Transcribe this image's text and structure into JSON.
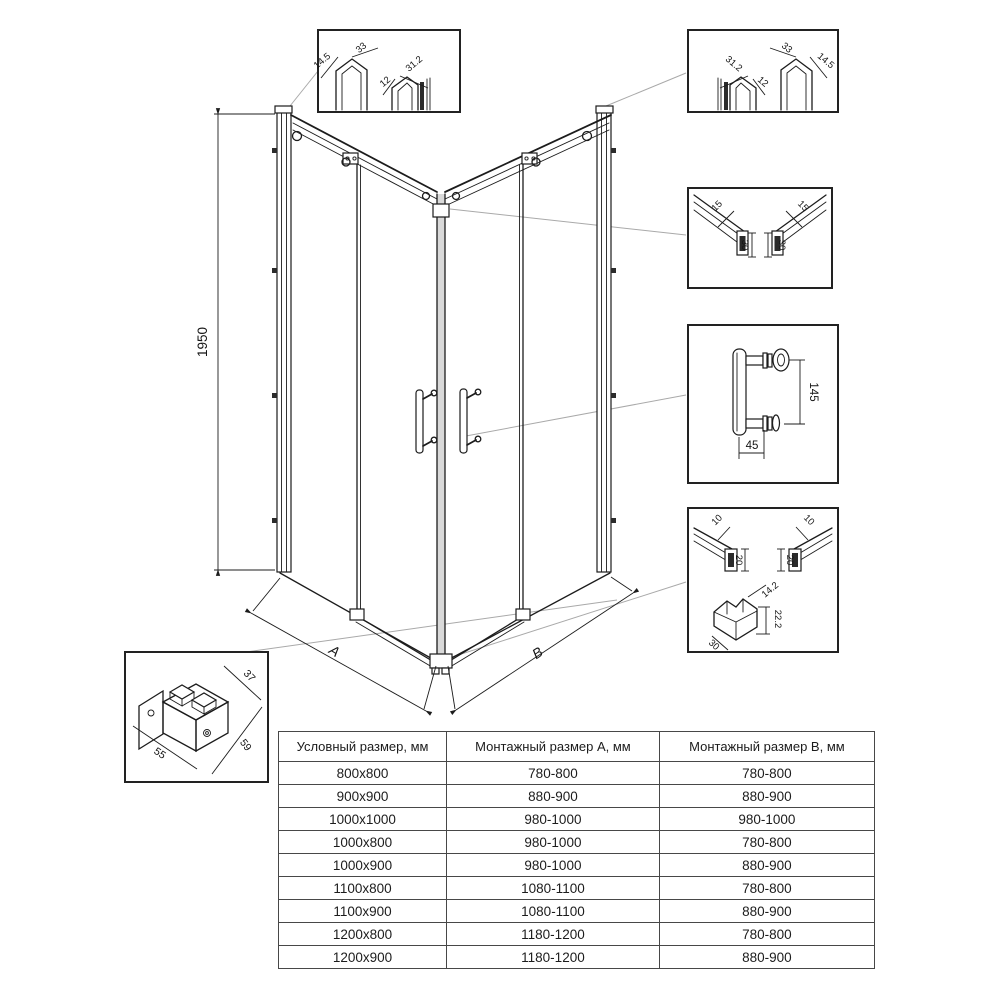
{
  "drawing": {
    "height_dim": "1950",
    "dim_a": "A",
    "dim_b": "B"
  },
  "details": {
    "wall_profile_left": {
      "dims": [
        "14.5",
        "33",
        "12",
        "31.2"
      ]
    },
    "wall_profile_right": {
      "dims": [
        "31.2",
        "12",
        "33",
        "14.5"
      ]
    },
    "top_rail": {
      "dims": [
        "15",
        "30",
        "15",
        "30"
      ]
    },
    "handle": {
      "dims": [
        "145",
        "45"
      ]
    },
    "bottom_rail": {
      "dims": [
        "10",
        "20",
        "10",
        "20"
      ]
    },
    "corner_block": {
      "dims": [
        "14.2",
        "22.2",
        "30"
      ]
    },
    "corner_bracket": {
      "dims": [
        "55",
        "59",
        "37"
      ]
    }
  },
  "table": {
    "headers": [
      "Условный размер, мм",
      "Монтажный размер А, мм",
      "Монтажный размер В, мм"
    ],
    "rows": [
      [
        "800x800",
        "780-800",
        "780-800"
      ],
      [
        "900x900",
        "880-900",
        "880-900"
      ],
      [
        "1000x1000",
        "980-1000",
        "980-1000"
      ],
      [
        "1000x800",
        "980-1000",
        "780-800"
      ],
      [
        "1000x900",
        "980-1000",
        "880-900"
      ],
      [
        "1100x800",
        "1080-1100",
        "780-800"
      ],
      [
        "1100x900",
        "1080-1100",
        "880-900"
      ],
      [
        "1200x800",
        "1180-1200",
        "780-800"
      ],
      [
        "1200x900",
        "1180-1200",
        "880-900"
      ]
    ]
  }
}
